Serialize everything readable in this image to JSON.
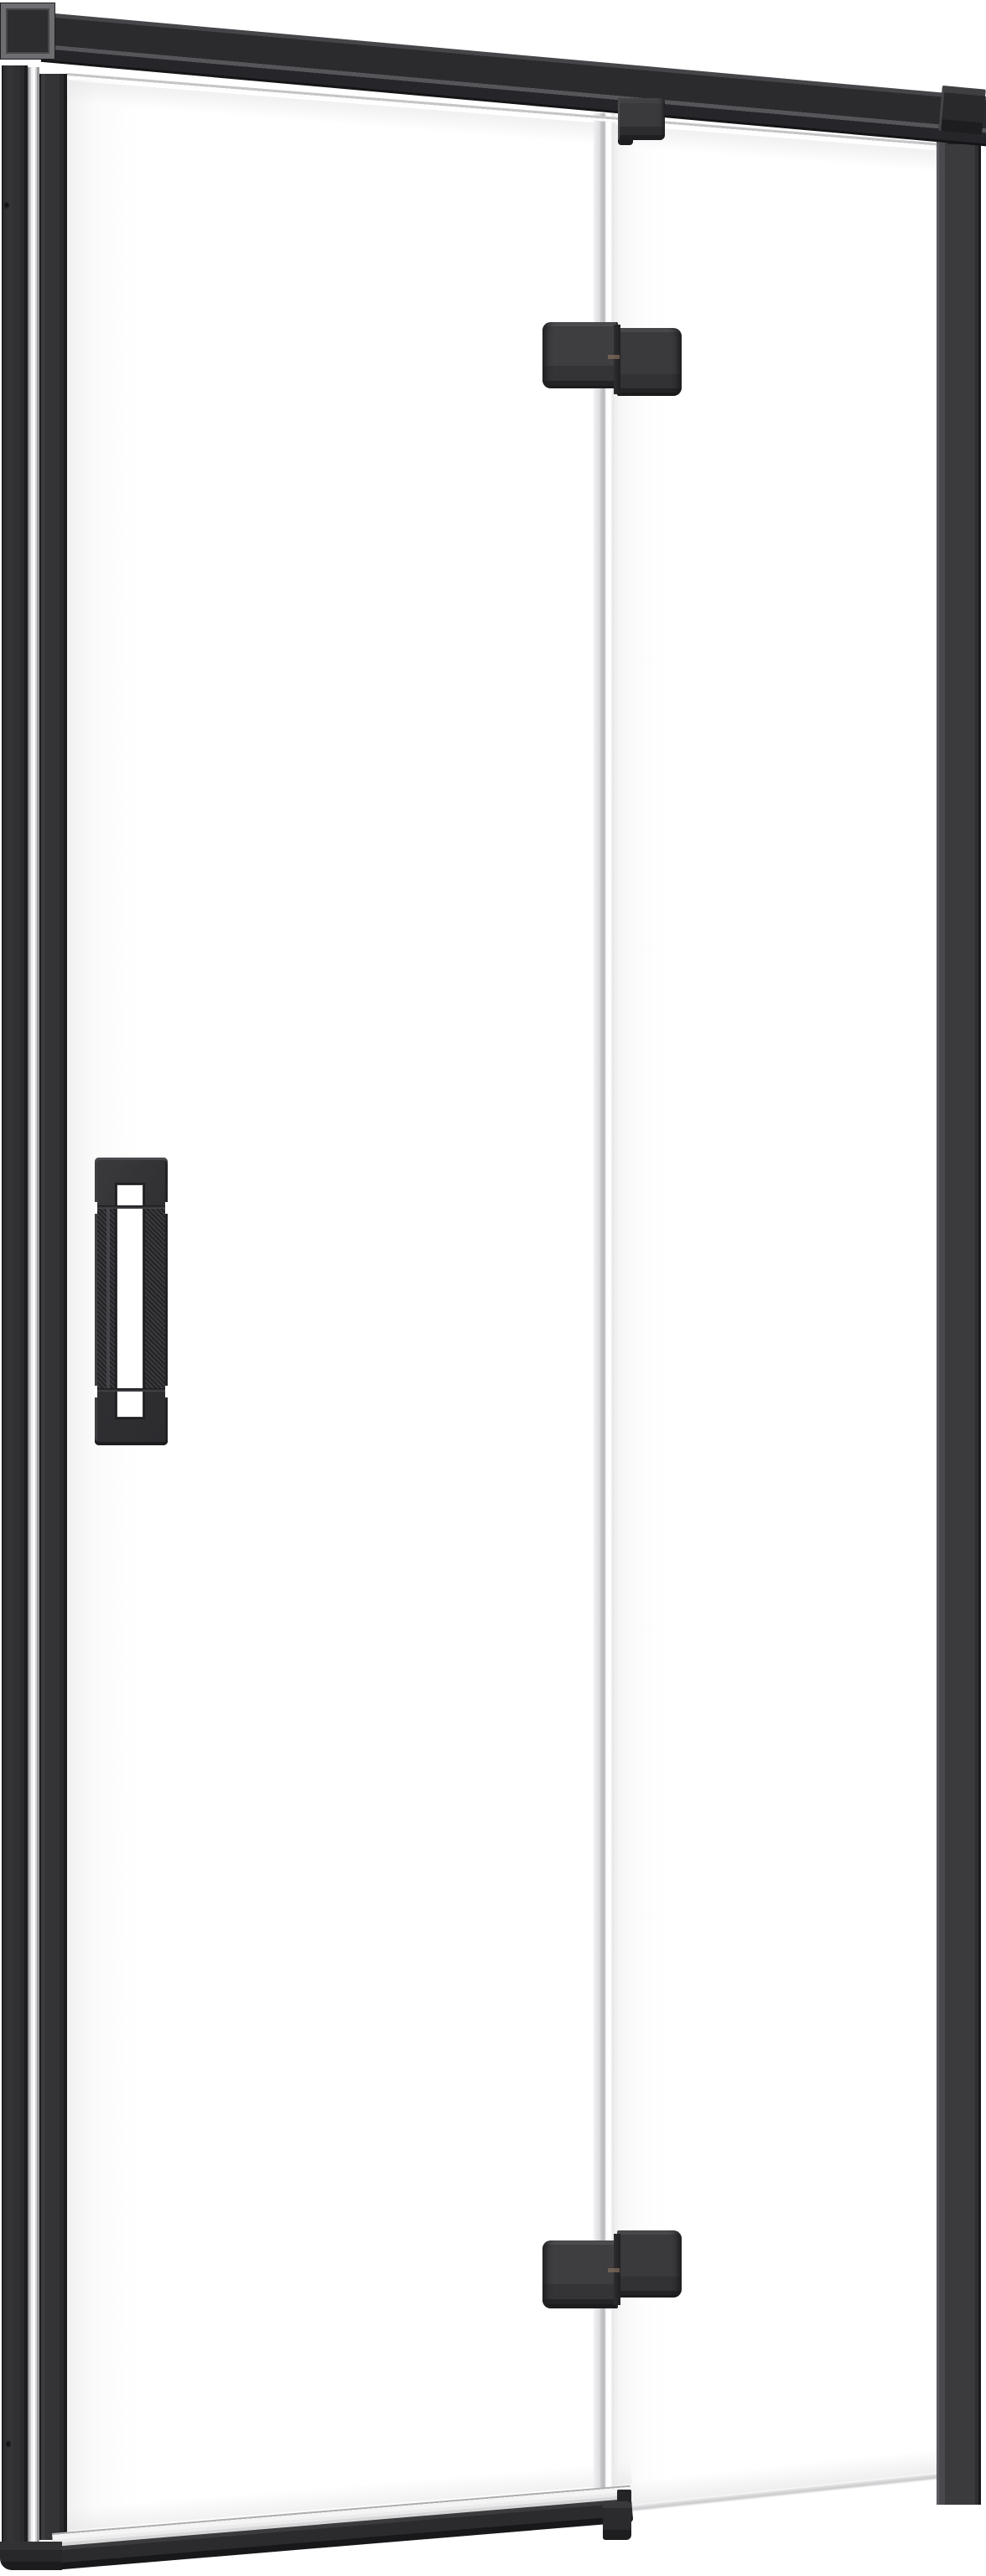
{
  "scene": {
    "description": "Product render of a hinged shower door: clear glass panels in a matte black frame, wall profile on the left, top support bar, two pivot hinges on the central glass seam, vertical bar handle, bottom seal rail",
    "background": "#ffffff"
  },
  "colors": {
    "background": "#ffffff",
    "black_edge": "#1d1d1f",
    "frame_dark": "#2b2b2d",
    "frame": "#343436",
    "frame_face": "#3a3a3c",
    "frame_light": "#4a4a4e",
    "frame_lighter": "#55555a",
    "bevel": "#6d6d71",
    "glass_mid": "#c5c5c7",
    "glass_light": "#e8e8ea",
    "seal": "#f4f4f5",
    "white": "#ffffff",
    "accent_brass": "#8b7360"
  },
  "parts": {
    "wall_mount_block": "wall mount block",
    "top_support_bar": "top support bar",
    "top_bar_end_cap": "support bar end cap",
    "left_wall_profile": "left wall profile",
    "glass_edge_strip": "hinge-side glass edge",
    "door_hinge_profile": "door hinge-side profile",
    "door_glass": "hinged door glass panel",
    "fixed_glass": "fixed side glass panel",
    "glass_seam": "door-to-fixed-panel seam",
    "top_clamp_bracket": "top glass clamp bracket",
    "hinge_top": "top pivot hinge",
    "hinge_bottom": "bottom pivot hinge",
    "door_handle": "vertical bar handle",
    "right_wall_profile": "right side profile",
    "bottom_seal": "bottom seal strip",
    "bottom_rail": "door bottom rail",
    "bottom_left_foot": "bottom corner foot",
    "rail_end_cap": "bottom rail end cap",
    "screws": "wall profile fixing screws"
  }
}
